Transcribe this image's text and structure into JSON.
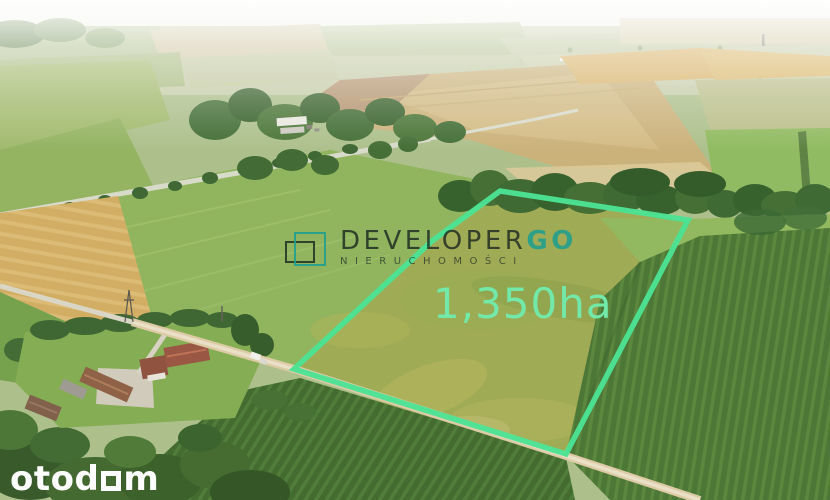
{
  "theme": {
    "plot-outline": "#4ce294",
    "plot-label": "#72e8a9",
    "brand-dark": "rgba(25,37,31,0.8)",
    "brand-teal": "rgba(30,158,144,0.88)",
    "brand-sub": "rgba(28,42,35,0.7)",
    "logo-white": "#ffffff"
  },
  "watermark": {
    "brand_primary": "DEVELOPER",
    "brand_accent": "GO",
    "subtitle": "NIERUCHOMOŚCI"
  },
  "plot": {
    "area_label": "1,350ha",
    "polygon_points": "500,191 688,220 566,454 294,369 432,241"
  },
  "portal": {
    "logo_prefix": "otod",
    "logo_suffix": "m"
  }
}
